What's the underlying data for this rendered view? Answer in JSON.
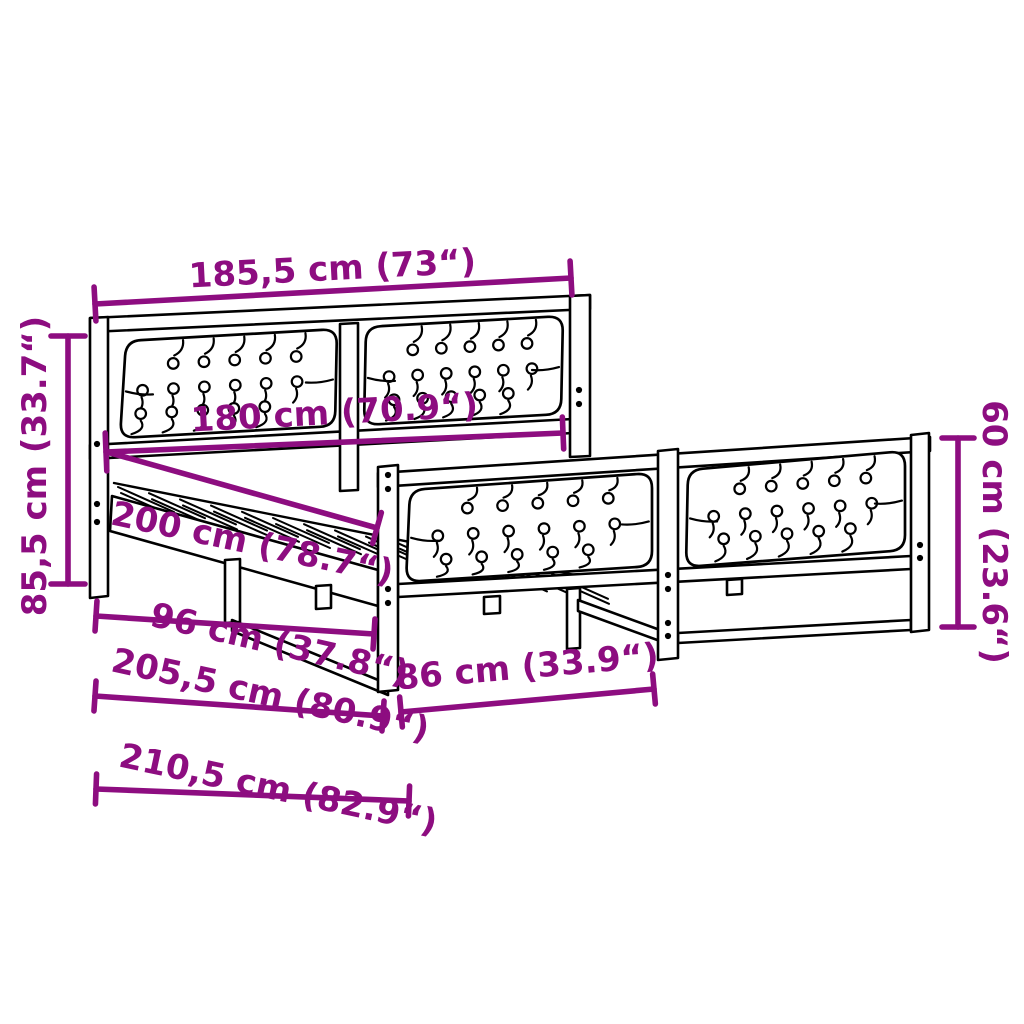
{
  "diagram": {
    "title": "Bed frame dimension diagram",
    "product": "Bed frame with button-tufted upholstered headboard and footboard",
    "unit_note": "centimetres with inches in parentheses",
    "colors": {
      "dimension_annotations": "#8D0D80",
      "line_art": "#000000",
      "background": "#FFFFFF"
    },
    "dimensions": {
      "outer_width": "185,5 cm (73“)",
      "headboard_height": "85,5 cm (33.7“)",
      "inner_width": "180 cm (70.9“)",
      "inner_length": "200 cm (78.7“)",
      "support_length": "96 cm (37.8“)",
      "frame_length": "205,5 cm (80.9“)",
      "total_length": "210,5 cm (82.9“)",
      "footboard_section_width": "86 cm (33.9“)",
      "footboard_height": "60 cm (23.6“)"
    }
  }
}
